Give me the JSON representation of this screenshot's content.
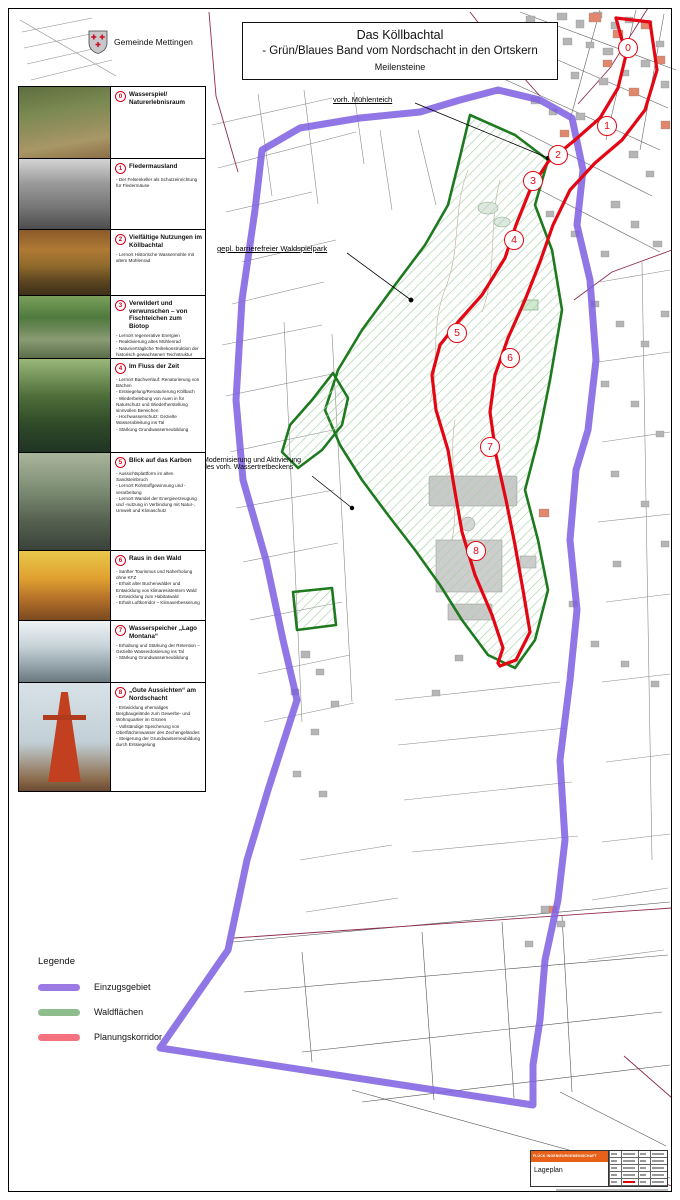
{
  "document": {
    "title_line1": "Das Köllbachtal",
    "title_line2": "- Grün/Blaues Band vom Nordschacht in den Ortskern",
    "subtitle": "Meilensteine",
    "municipality": "Gemeinde Mettingen"
  },
  "milestones": [
    {
      "number": "0",
      "title": "Wasserspiel/ Naturerlebnisraum",
      "bullets": []
    },
    {
      "number": "1",
      "title": "Fledermausland",
      "bullets": [
        "Der Felsenkeller als Schutzeinrichtung für Fledermäuse"
      ]
    },
    {
      "number": "2",
      "title": "Vielfältige Nutzungen im Köllbachtal",
      "bullets": [
        "Lernort Historische Wassermühle mit altem Mühlenrad"
      ]
    },
    {
      "number": "3",
      "title": "Verwildert und verwunschen – von Fischteichen zum Biotop",
      "bullets": [
        "Lernort regenerative Energien",
        "Reaktivierung altes Mühlenrad",
        "Naturverträgliche Teilrekonstruktion der historisch gewachsenen Teichstruktur"
      ]
    },
    {
      "number": "4",
      "title": "Im Fluss der Zeit",
      "bullets": [
        "Lernort Bachverlauf: Renaturierung von Bächen",
        "Entsiegelung/Renaturierung Köllbach",
        "Wiederbelebung von Auen in für Naturschutz und Wiederherstellung sinnvollen Bereichen",
        "Hochwasserschutz: Gezielte Wasserableitung ins Tal",
        "Stärkung Grundwasserneubildung"
      ]
    },
    {
      "number": "5",
      "title": "Blick auf das Karbon",
      "bullets": [
        "Aussichtsplattform im alten Sandsteinbruch",
        "Lernort Rohstoffgewinnung und -verarbeitung",
        "Lernort Wandel der Energieerzeugung und -nutzung in Verbindung mit Natur-, Umwelt und Klimaschutz"
      ]
    },
    {
      "number": "6",
      "title": "Raus in den Wald",
      "bullets": [
        "Sanfter Tourismus und Naherholung ohne KFZ",
        "Erhalt alter Buchenwälder und Entwicklung von klimaresistentem Wald",
        "Entwicklung zum Habitatwald",
        "Erhalt Luftkorridor – Klimaverbesserung"
      ]
    },
    {
      "number": "7",
      "title": "Wasserspeicher „Lago Montana“",
      "bullets": [
        "Erhaltung und Stärkung der Retention – Gezielte Wasserdosierung ins Tal",
        "Stärkung Grundwasserneubildung"
      ]
    },
    {
      "number": "8",
      "title": "„Gute Aussichten“ am Nordschacht",
      "bullets": [
        "Entwicklung ehemaliges Bergbaugelände zum Gewerbe- und Wohnquartier im Grünen",
        "Vollständige Speicherung von Oberflächenwasser des Zechengeländes",
        "Steigerung der Grundwasserneubildung durch Entsiegelung"
      ]
    }
  ],
  "map_labels": {
    "muehlenteich": "vorh. Mühlenteich",
    "waldspielpark": "gepl. barrierefreier Waldspielpark",
    "wassertretbecken_line1": "Modernisierung und Aktivierung",
    "wassertretbecken_line2": "des vorh. Wassertretbeckens"
  },
  "map_markers": [
    "0",
    "1",
    "2",
    "3",
    "4",
    "5",
    "6",
    "7",
    "8"
  ],
  "legend": {
    "title": "Legende",
    "items": [
      {
        "label": "Einzugsgebiet",
        "color": "#9b7ae3"
      },
      {
        "label": "Waldflächen",
        "color": "#8dbd8d"
      },
      {
        "label": "Planungskorridor",
        "color": "#f4717f"
      }
    ]
  },
  "title_block": {
    "company": "FLÜCK INGENIEURGEMEINSCHAFT",
    "drawing_type": "Lageplan"
  },
  "colors": {
    "einzugsgebiet_line": "#7e5fe0",
    "waldflaeche_border": "#1e7a1e",
    "planungskorridor_line": "#e30613",
    "marker_red": "#e30613",
    "title_block_orange": "#e8611a"
  }
}
